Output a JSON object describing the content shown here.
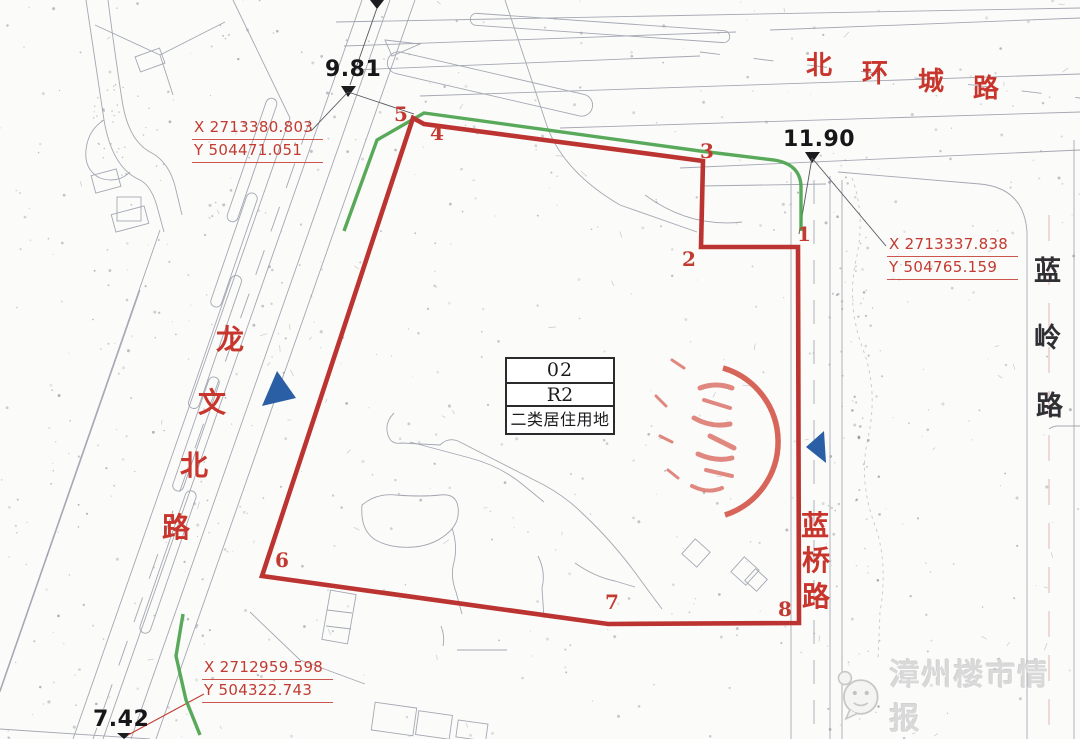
{
  "map": {
    "elevations": [
      {
        "id": "elev-top-left",
        "value": "9.81",
        "x": 325,
        "y": 57
      },
      {
        "id": "elev-top-right",
        "value": "11.90",
        "x": 783,
        "y": 127
      },
      {
        "id": "elev-bottom",
        "value": "7.42",
        "x": 93,
        "y": 707
      }
    ],
    "coordinates": [
      {
        "id": "coord-top-left",
        "x_label": "X 2713380.803",
        "y_label": "Y 504471.051",
        "x": 192,
        "y": 117
      },
      {
        "id": "coord-right",
        "x_label": "X 2713337.838",
        "y_label": "Y 504765.159",
        "x": 887,
        "y": 234
      },
      {
        "id": "coord-bottom-left",
        "x_label": "X 2712959.598",
        "y_label": "Y 504322.743",
        "x": 202,
        "y": 657
      }
    ],
    "parcel": {
      "code": "02",
      "zone_code": "R2",
      "land_use": "二类居住用地",
      "boundary_color": "#bc3431",
      "vertices": [
        {
          "n": "1",
          "x": 797,
          "y": 224
        },
        {
          "n": "2",
          "x": 682,
          "y": 249
        },
        {
          "n": "3",
          "x": 700,
          "y": 141
        },
        {
          "n": "4",
          "x": 430,
          "y": 123
        },
        {
          "n": "5",
          "x": 394,
          "y": 104
        },
        {
          "n": "6",
          "x": 275,
          "y": 550
        },
        {
          "n": "7",
          "x": 605,
          "y": 592
        },
        {
          "n": "8",
          "x": 778,
          "y": 599
        }
      ]
    },
    "roads": [
      {
        "id": "north-ring",
        "name": "北环城路",
        "color": "#c8352c",
        "size": 26,
        "chars": [
          {
            "c": "北",
            "x": 806,
            "y": 52
          },
          {
            "c": "环",
            "x": 862,
            "y": 60
          },
          {
            "c": "城",
            "x": 918,
            "y": 68
          },
          {
            "c": "路",
            "x": 973,
            "y": 75
          }
        ]
      },
      {
        "id": "longwen-north",
        "name": "龙文北路",
        "color": "#c8352c",
        "size": 28,
        "chars": [
          {
            "c": "龙",
            "x": 216,
            "y": 326
          },
          {
            "c": "文",
            "x": 198,
            "y": 389
          },
          {
            "c": "北",
            "x": 180,
            "y": 452
          },
          {
            "c": "路",
            "x": 162,
            "y": 514
          }
        ]
      },
      {
        "id": "lanqiao",
        "name": "蓝桥路",
        "color": "#c8352c",
        "size": 28,
        "chars": [
          {
            "c": "蓝",
            "x": 801,
            "y": 512
          },
          {
            "c": "桥",
            "x": 802,
            "y": 547
          },
          {
            "c": "路",
            "x": 802,
            "y": 583
          }
        ]
      },
      {
        "id": "lanling",
        "name": "蓝岭路",
        "color": "#2f2f34",
        "size": 27,
        "chars": [
          {
            "c": "蓝",
            "x": 1034,
            "y": 258
          },
          {
            "c": "岭",
            "x": 1034,
            "y": 325
          },
          {
            "c": "路",
            "x": 1036,
            "y": 393
          }
        ]
      }
    ],
    "watermark": {
      "text": "漳州楼市情报"
    },
    "colors": {
      "boundary_red": "#bc3431",
      "greenbelt": "#4aa34c",
      "arrow_blue": "#2b5fa5",
      "stamp_red": "#d04337",
      "label_red": "#c23a31"
    }
  }
}
